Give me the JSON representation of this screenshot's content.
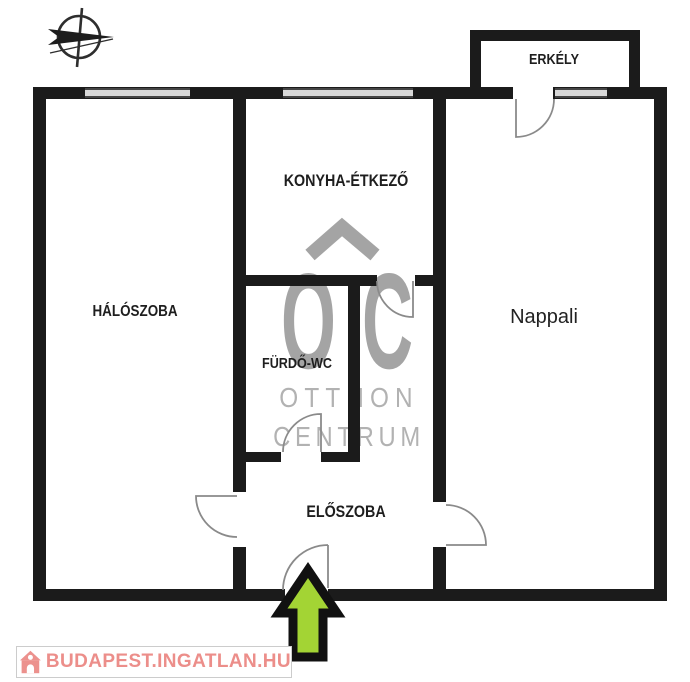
{
  "title": "Apartment floor plan",
  "rooms": {
    "erkely": "ERKÉLY",
    "konyha": "KONYHA-ÉTKEZŐ",
    "haloszoba": "HÁLÓSZOBA",
    "furdo": "FÜRDŐ-WC",
    "nappali": "Nappali",
    "eloszoba": "ELŐSZOBA"
  },
  "watermark": {
    "monogram": "OC",
    "name_line1": "OTTHON",
    "name_line2": "CENTRUM"
  },
  "branding": {
    "site": "BUDAPEST.INGATLAN.HU"
  },
  "icons": {
    "compass": "compass-north-icon",
    "entrance_arrow": "entrance-arrow-icon",
    "house": "house-logo-icon"
  },
  "colors": {
    "wall": "#1b1b1b",
    "window_fill": "#d8d8d8",
    "door_stroke": "#8a8a8a",
    "watermark_gray": "#a4a4a4",
    "watermark_light_gray": "#b2b2b2",
    "arrow_fill": "#a3d434",
    "arrow_outline": "#111111",
    "logo_pink": "#ec8e8a"
  }
}
